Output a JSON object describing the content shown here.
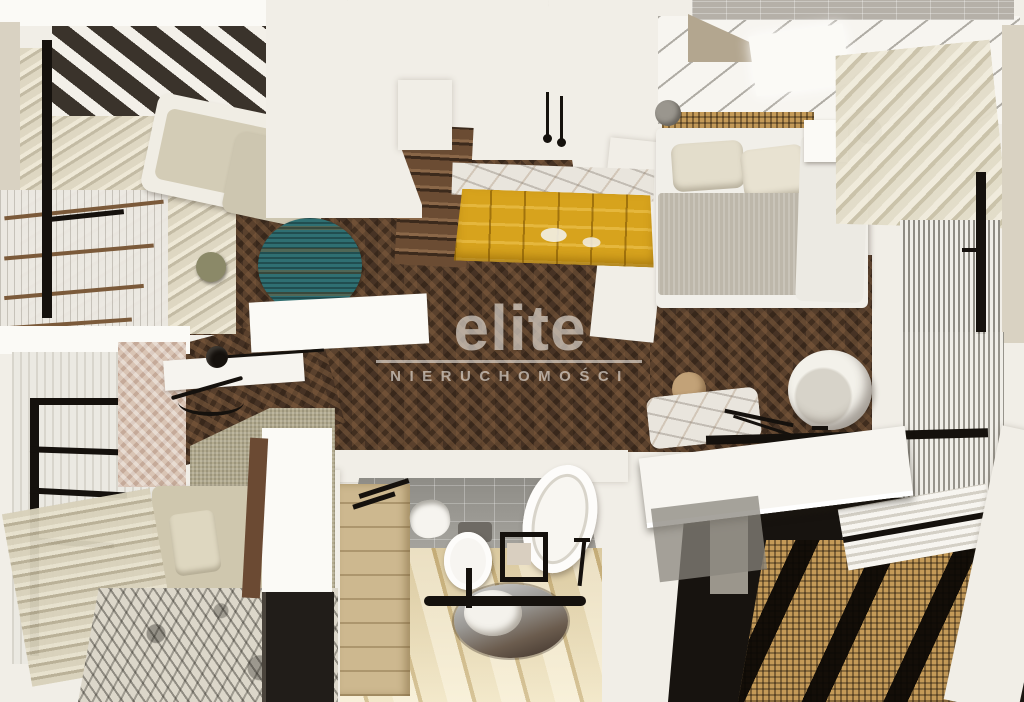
{
  "watermark": {
    "brand": "elite",
    "subtitle": "NIERUCHOMOŚCI"
  },
  "scene": {
    "type": "top-down 3D cutaway render of an apartment interior",
    "rooms": [
      "living-room",
      "kitchen",
      "hallway-with-stairs",
      "bedroom",
      "home-office",
      "bathroom",
      "wardrobe-area"
    ]
  },
  "colors": {
    "wall_white": "#f1eee7",
    "wall_bright": "#fbfaf6",
    "wall_beige": "#d9d2c2",
    "floor_wood": "#503a2a",
    "rug_teal": "#2f6f72",
    "sofa_beige": "#d3ccb6",
    "kitchen_gold": "#d7a31d",
    "marble": "#e9e5dd",
    "blanket_gray": "#bdb7aa",
    "rattan": "#c49a58",
    "black_accent": "#15110d",
    "tile_gray": "#9c9a94",
    "bath_floor": "#e6d6a8",
    "vanity_wood": "#cdb88f",
    "rug_botanical": "#dcd7ca",
    "carpet": "#b2aa8e",
    "brick_gray": "#b5b0a8",
    "dark_floor": "#17130f",
    "watermark": "rgba(237,233,226,0.62)"
  }
}
